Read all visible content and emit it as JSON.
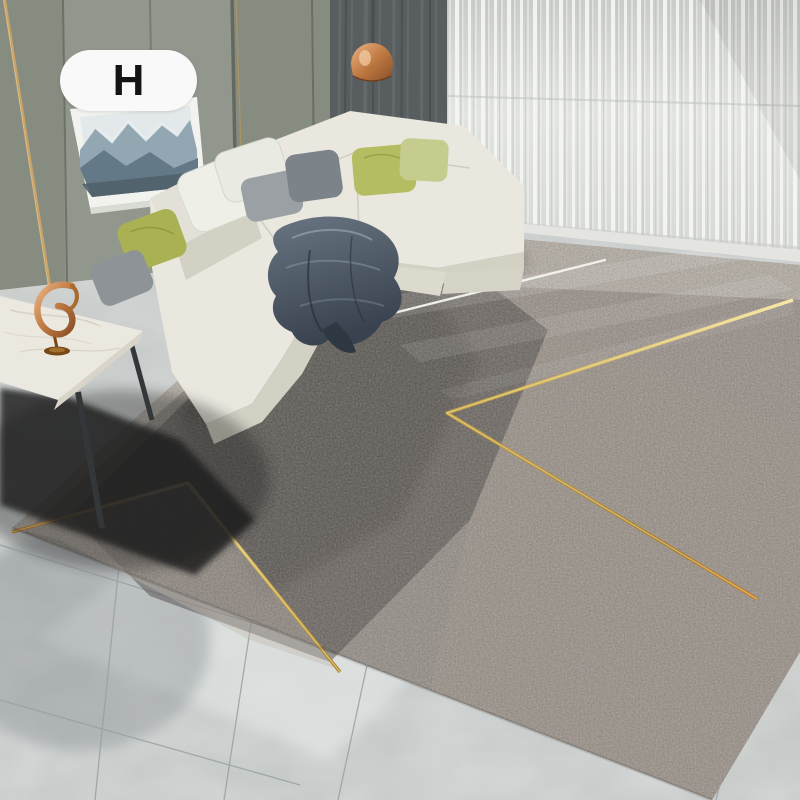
{
  "photo": {
    "alt": "Modern living room with white L-shaped sofa, sheer curtains, mountain wall art, copper pendant lamp, marble side table with gold sculpture, and a large gray geometric area rug with thin gold chevron lines on marble tile floor"
  },
  "badge": {
    "label": "H"
  },
  "palette": {
    "wall": "#878c80",
    "wallLight": "#9ba197",
    "wallSeam": "#565c51",
    "goldTrim": "#b0925e",
    "curtainDark": "#585e60",
    "curtainDarkFold": "#6d7375",
    "sheerStripe": "#f7f8f6",
    "sheerShade": "#bfc2be",
    "sill": "#e4e5e1",
    "tile": "#c4c8c7",
    "grout": "#9aa0a0",
    "tileHighlight": "#e9edec",
    "tileShadow": "#70767a",
    "rugBase": "#98928b",
    "rugDark": "#4f4c4a",
    "rugLightBand": "#cac3b9",
    "rugMauve": "#a39890",
    "rugCorner": "#c2b9ae",
    "gold": "#c9a84c",
    "goldLight": "#f6e7a6",
    "goldDeep": "#a97f2b",
    "goldOrange": "#c87f2a",
    "whiteLine": "#f4f4ef",
    "sofa": "#e9e7de",
    "sofaShade": "#d3d1c4",
    "pillowWhite": "#eef0e8",
    "pillowGray": "#9aa0a3",
    "pillowGrayDark": "#7d8489",
    "pillowGreen": "#b5bd62",
    "pillowOlive": "#a9b152",
    "pillowGreenPale": "#c6cb8e",
    "throwBase": "#4a5563",
    "throwLight": "#97a2ae",
    "throwDark": "#222a34",
    "marble": "#ebe8e0",
    "marbleVein": "#d2ccbf",
    "tableEdge": "#d8d4c9",
    "leg": "#33373a",
    "sculptureDark": "#774715",
    "cord": "#4a4c4d",
    "artMid": "#93a7b3",
    "artSnow": "#eef3f4",
    "artFront": "#647987",
    "artSky": "#e3e9ea",
    "frame": "#f2f3ef",
    "frameEdge": "#d9dcd5",
    "badgeBg": "#f8f9f8",
    "badgeText": "#141414",
    "shadow": "#1a1c1e"
  }
}
